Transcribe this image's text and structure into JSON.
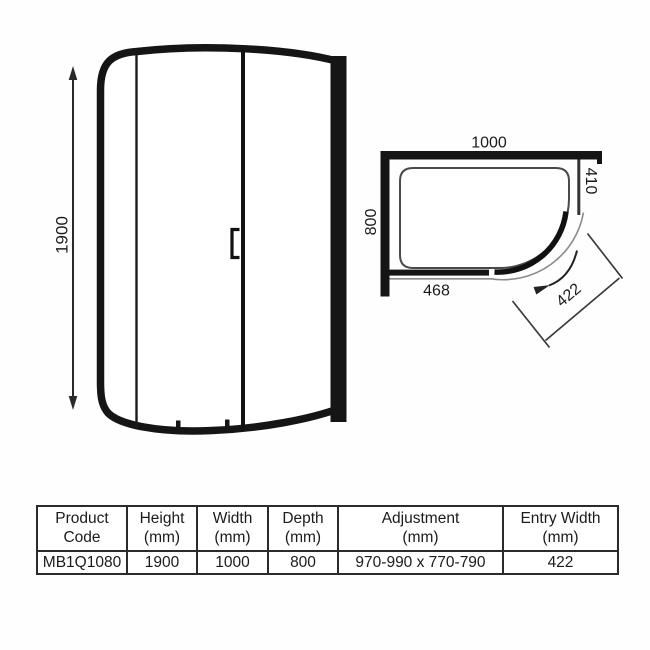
{
  "diagram": {
    "front_view": {
      "height": "1900"
    },
    "plan_view": {
      "width": "1000",
      "depth": "800",
      "side_panel_width": "410",
      "front_panel_width": "468",
      "entry_width": "422"
    }
  },
  "table": {
    "columns": [
      {
        "line1": "Product",
        "line2": "Code"
      },
      {
        "line1": "Height",
        "line2": "(mm)"
      },
      {
        "line1": "Width",
        "line2": "(mm)"
      },
      {
        "line1": "Depth",
        "line2": "(mm)"
      },
      {
        "line1": "Adjustment",
        "line2": "(mm)"
      },
      {
        "line1": "Entry Width",
        "line2": "(mm)"
      }
    ],
    "row": [
      "MB1Q1080",
      "1900",
      "1000",
      "800",
      "970-990 x 770-790",
      "422"
    ]
  },
  "colors": {
    "line": "#151515",
    "thin_line": "#4a4a4a",
    "track_line": "#8a8a8a",
    "text": "#1b1b1b",
    "background": "#ffffff"
  }
}
